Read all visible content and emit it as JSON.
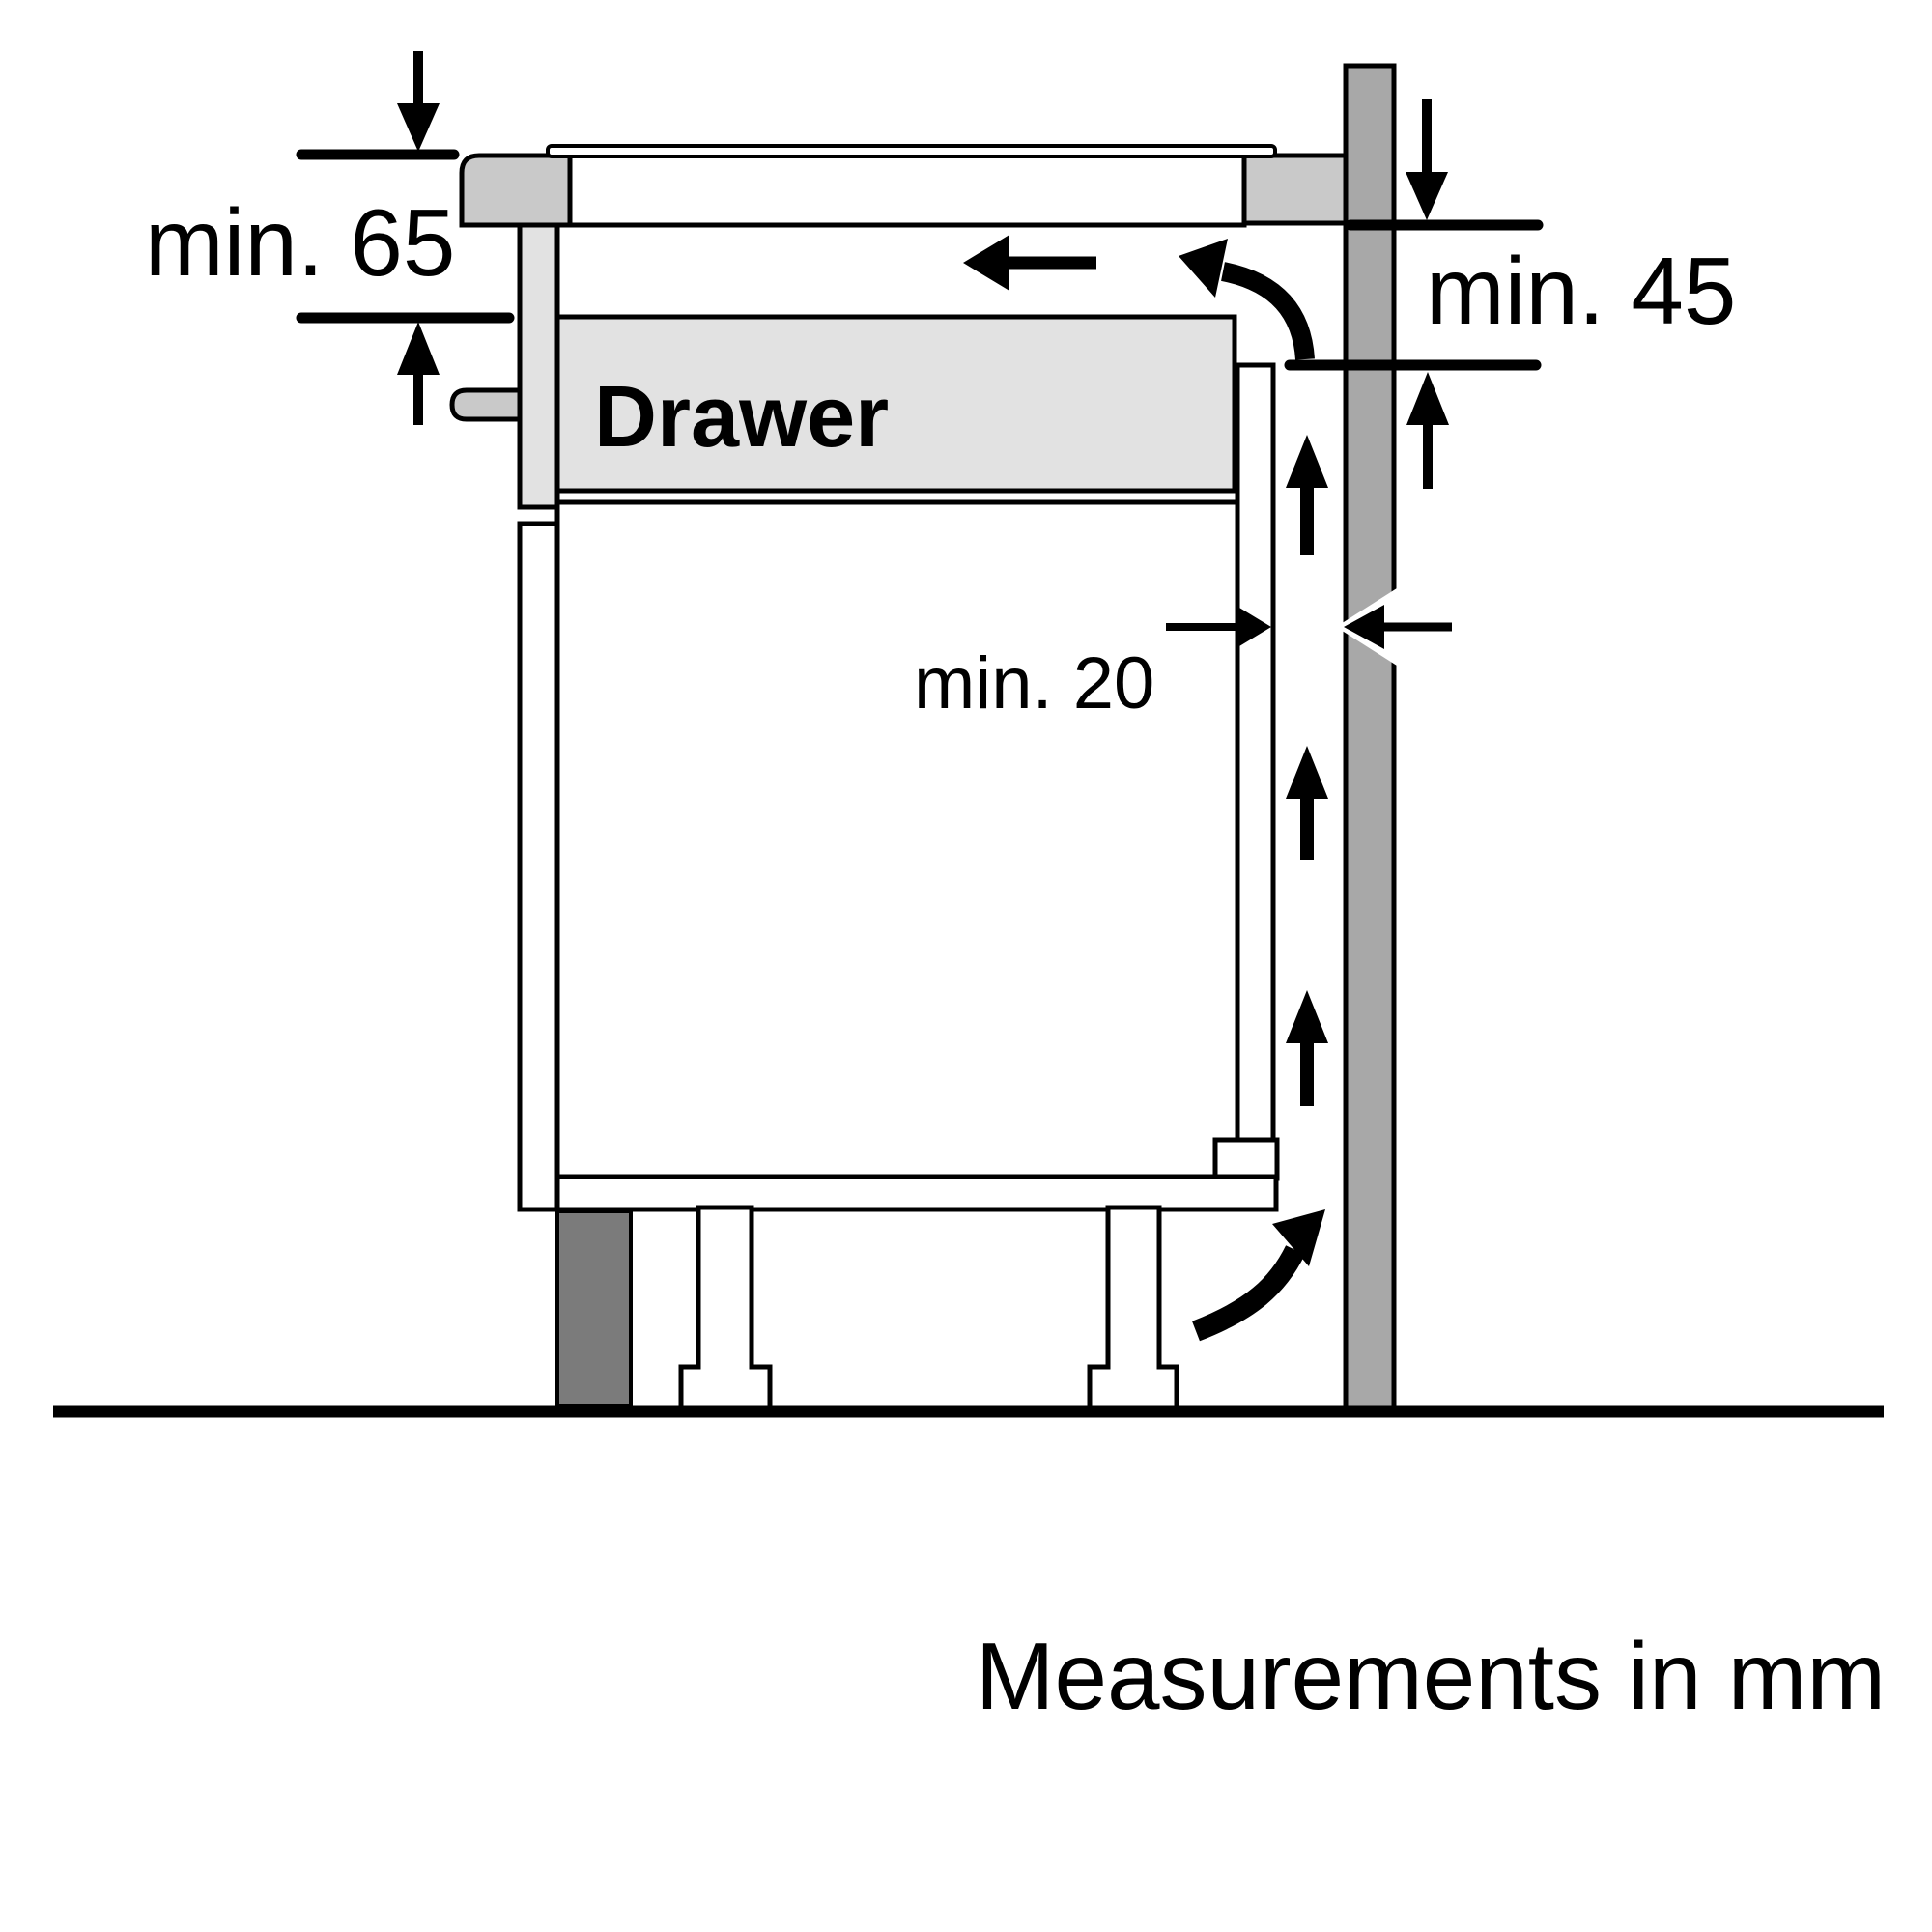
{
  "diagram": {
    "title": "Hob installation side-view diagram",
    "labels": {
      "min65": "min. 65",
      "min45": "min. 45",
      "min20": "min. 20",
      "drawer": "Drawer",
      "footer": "Measurements in mm"
    },
    "colors": {
      "outline": "#000000",
      "background": "#ffffff",
      "hob_gray": "#c9c9c9",
      "panel_gray": "#e2e2e2",
      "wall_gray": "#a8a8a8",
      "plinth_gray": "#7b7b7b"
    }
  }
}
